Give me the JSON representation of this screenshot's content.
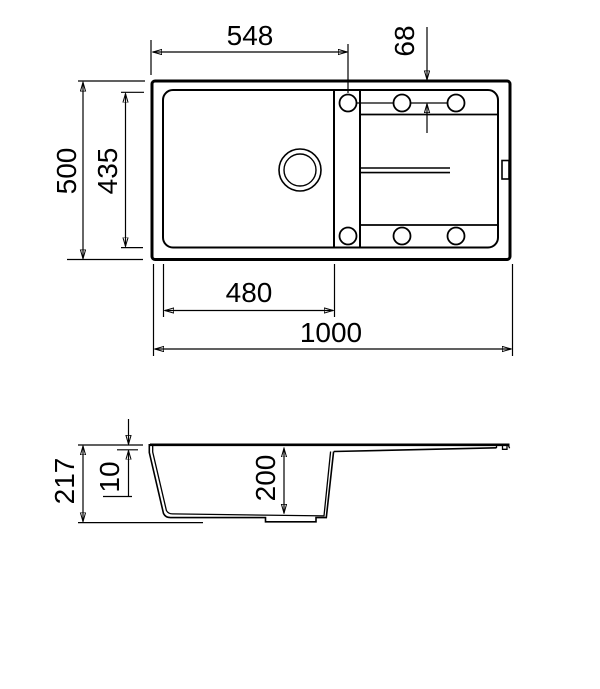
{
  "canvas": {
    "background": "#ffffff",
    "line_color": "#000000"
  },
  "top_view": {
    "dims": {
      "faucet_offset_x": "548",
      "faucet_offset_y": "68",
      "overall_depth": "500",
      "inner_depth": "435",
      "bowl_width": "480",
      "overall_width": "1000"
    }
  },
  "side_view": {
    "dims": {
      "overall_height": "217",
      "rim_thickness": "10",
      "bowl_depth": "200"
    }
  }
}
